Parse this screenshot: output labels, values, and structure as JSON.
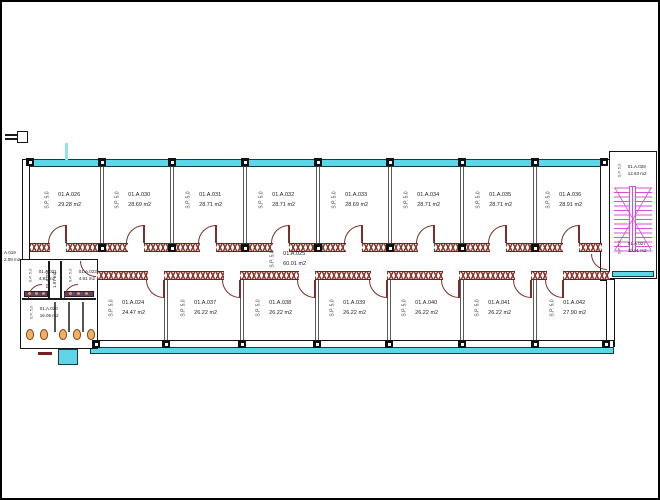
{
  "note_vertical": "S.P. 5,0",
  "rooms_top": [
    {
      "id": "01.A.026",
      "area": "29.28 m2"
    },
    {
      "id": "01.A.030",
      "area": "28.69 m2"
    },
    {
      "id": "01.A.031",
      "area": "28.71 m2"
    },
    {
      "id": "01.A.032",
      "area": "28.71 m2"
    },
    {
      "id": "01.A.033",
      "area": "28.69 m2"
    },
    {
      "id": "01.A.034",
      "area": "28.71 m2"
    },
    {
      "id": "01.A.035",
      "area": "28.71 m2"
    },
    {
      "id": "01.A.036",
      "area": "28.91 m2"
    }
  ],
  "corridor": {
    "id": "01.A.025",
    "area": "60.01 m2"
  },
  "rooms_bottom": [
    {
      "id": "01.A.024",
      "area": "24.47 m2"
    },
    {
      "id": "01.A.037",
      "area": "26.22 m2"
    },
    {
      "id": "01.A.038",
      "area": "26.22 m2"
    },
    {
      "id": "01.A.039",
      "area": "26.22 m2"
    },
    {
      "id": "01.A.040",
      "area": "26.22 m2"
    },
    {
      "id": "01.A.041",
      "area": "26.22 m2"
    },
    {
      "id": "01.A.042",
      "area": "27.90 m2"
    }
  ],
  "stair_upper": {
    "id": "01.A.028",
    "area": "12.63 m2"
  },
  "stair_lower": {
    "id": "01.A.027",
    "area": "10.01 m2"
  },
  "annex_outside_label": {
    "id": "A.019",
    "area": "2.09 m2"
  },
  "annex_rooms": [
    {
      "id": "01.A.021",
      "area": "4.91 m2"
    },
    {
      "id": "01.A.022",
      "area": "1.97 m2"
    },
    {
      "id": "01.A.023",
      "area": "4.91 m2"
    },
    {
      "id": "01.A.020",
      "area": "16.06 m2"
    }
  ],
  "colors": {
    "exterior_wall_accent": "#5fd6e8",
    "stair": "#d44fd4",
    "partition_hatch": "#8c3b32",
    "fixture": "#f5b063"
  }
}
